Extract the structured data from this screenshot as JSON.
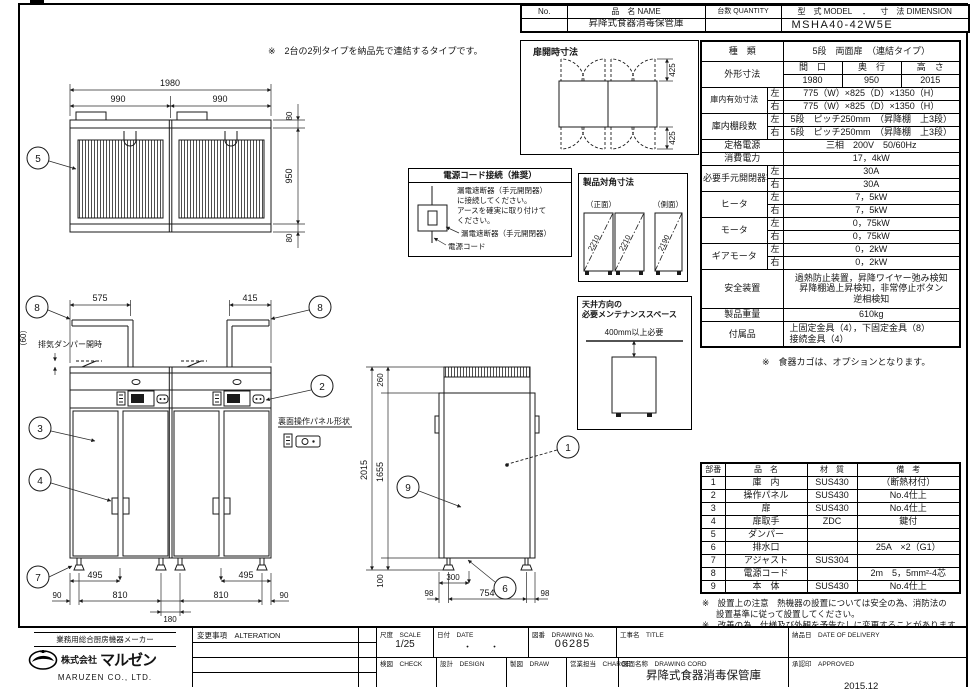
{
  "sheet": {
    "top_note": "※　2台の2列タイプを納品先で連結するタイプです。"
  },
  "header": {
    "no_label": "No.",
    "name_label": "品　名 NAME",
    "name_value": "昇降式食器消毒保管庫",
    "qty_label": "台数 QUANTITY",
    "model_label": "型　式 MODEL",
    "sep": "．",
    "dim_label": "寸　法 DIMENSION",
    "model_value": "MSHA40-42W5E"
  },
  "spec": {
    "left": "左",
    "right": "右",
    "kind_label": "種　類",
    "kind_value": "5段　両面扉　（連結タイプ）",
    "outer_label": "外形寸法",
    "w_label": "間　口",
    "d_label": "奥　行",
    "h_label": "高　さ",
    "w_value": "1980",
    "d_value": "950",
    "h_value": "2015",
    "inner_label": "庫内有効寸法",
    "inner_left": "775（W）×825（D）×1350（H）",
    "inner_right": "775（W）×825（D）×1350（H）",
    "shelf_label": "庫内棚段数",
    "shelf_left": "5段　ピッチ250mm　（昇降棚　上3段）",
    "shelf_right": "5段　ピッチ250mm　（昇降棚　上3段）",
    "power_label": "定格電源",
    "power_value": "三相　200V　50/60Hz",
    "consumption_label": "消費電力",
    "consumption_value": "17，4kW",
    "breaker_label": "必要手元開閉器容量",
    "breaker_left": "30A",
    "breaker_right": "30A",
    "heater_label": "ヒータ",
    "heater_left": "7，5kW",
    "heater_right": "7，5kW",
    "motor_label": "モータ",
    "motor_left": "0，75kW",
    "motor_right": "0，75kW",
    "gearmotor_label": "ギアモータ",
    "gearmotor_left": "0，2kW",
    "gearmotor_right": "0，2kW",
    "safety_label": "安全装置",
    "safety_line1": "過熱防止装置，昇降ワイヤー弛み検知",
    "safety_line2": "昇降棚過上昇検知，非常停止ボタン",
    "safety_line3": "逆相検知",
    "weight_label": "製品重量",
    "weight_value": "610kg",
    "accessory_label": "付属品",
    "accessory_line1": "上固定金具（4），下固定金具（8）",
    "accessory_line2": "接続金具（4）",
    "note": "※　食器カゴは、オプションとなります。"
  },
  "parts": {
    "headers": [
      "部番",
      "品　名",
      "材　質",
      "備　考"
    ],
    "rows": [
      [
        "1",
        "庫　内",
        "SUS430",
        "（断熱材付）"
      ],
      [
        "2",
        "操作パネル",
        "SUS430",
        "No.4仕上"
      ],
      [
        "3",
        "扉",
        "SUS430",
        "No.4仕上"
      ],
      [
        "4",
        "扉取手",
        "ZDC",
        "鍵付"
      ],
      [
        "5",
        "ダンパー",
        "",
        ""
      ],
      [
        "6",
        "排水口",
        "",
        "25A　×2（G1）"
      ],
      [
        "7",
        "アジャスト",
        "SUS304",
        ""
      ],
      [
        "8",
        "電源コード",
        "",
        "2m　5，5mm²-4芯"
      ],
      [
        "9",
        "本　体",
        "SUS430",
        "No.4仕上"
      ]
    ],
    "note1": "※　設置上の注意　熱機器の設置については安全の為、消防法の",
    "note1b": "設置基準に従って設置してください。",
    "note2": "※　改善の為、仕様及び外観を予告なしに変更することがあります。"
  },
  "titleblock": {
    "maker_tagline": "業務用総合厨房機器メーカー",
    "company_prefix": "株式会社",
    "company_name": "マルゼン",
    "company_en": "MARUZEN  CO., LTD.",
    "alteration_label": "変更事項　ALTERATION",
    "scale_label": "尺度　SCALE",
    "scale_value": "1/25",
    "date_label": "日付　DATE",
    "date_value": "・　　・",
    "dwgno_label": "図番　DRAWING No.",
    "dwgno_value": "06285",
    "title_label": "工事名　TITLE",
    "delivery_label": "納品日　DATE OF DELIVERY",
    "check_label": "検図　CHECK",
    "design_label": "設計　DESIGN",
    "draw_label": "製図　DRAW",
    "charge_label": "営業担当　CHARGE",
    "dwgname_label": "図面名称　DRAWING CORD",
    "dwgname_value": "昇降式食器消毒保管庫",
    "approved_label": "承認印　APPROVED",
    "date_stamp": "2015.12"
  },
  "drawing": {
    "balloons": {
      "n1": "1",
      "n2": "2",
      "n3": "3",
      "n4": "4",
      "n5": "5",
      "n6": "6",
      "n7": "7",
      "n8": "8",
      "n9": "9"
    },
    "top_view": {
      "d1980": "1980",
      "d990a": "990",
      "d990b": "990",
      "d80a": "80",
      "d950": "950",
      "d80b": "80"
    },
    "front_view": {
      "d575": "575",
      "d415": "415",
      "d60": "（60）",
      "damper_note": "排気ダンパー開時",
      "d495a": "495",
      "d495b": "495",
      "d90a": "90",
      "d810a": "810",
      "d180": "180",
      "d810b": "810",
      "d90b": "90",
      "rear_panel_label": "裏面操作パネル形状"
    },
    "side_view": {
      "d260": "260",
      "d2015": "2015",
      "d1655": "1655",
      "d100": "100",
      "d300": "300",
      "d98a": "98",
      "d754": "754",
      "d98b": "98"
    },
    "door_box": {
      "title": "扉開時寸法",
      "d425a": "425",
      "d425b": "425"
    },
    "power_box": {
      "title": "電源コード接続（推奨）",
      "line1": "漏電遮断器（手元開閉器）",
      "line2": "に接続してください。",
      "line3": "アースを確実に取り付けて",
      "line4": "ください。",
      "label1": "漏電遮断器（手元開閉器）",
      "label2": "電源コード"
    },
    "diagonal_box": {
      "title": "製品対角寸法",
      "front_label": "（正面）",
      "side_label": "（側面）",
      "v1": "2210",
      "v2": "2210",
      "v3": "2190"
    },
    "ceiling_box": {
      "title_line1": "天井方向の",
      "title_line2": "必要メンテナンススペース",
      "clearance": "400mm以上必要"
    }
  }
}
